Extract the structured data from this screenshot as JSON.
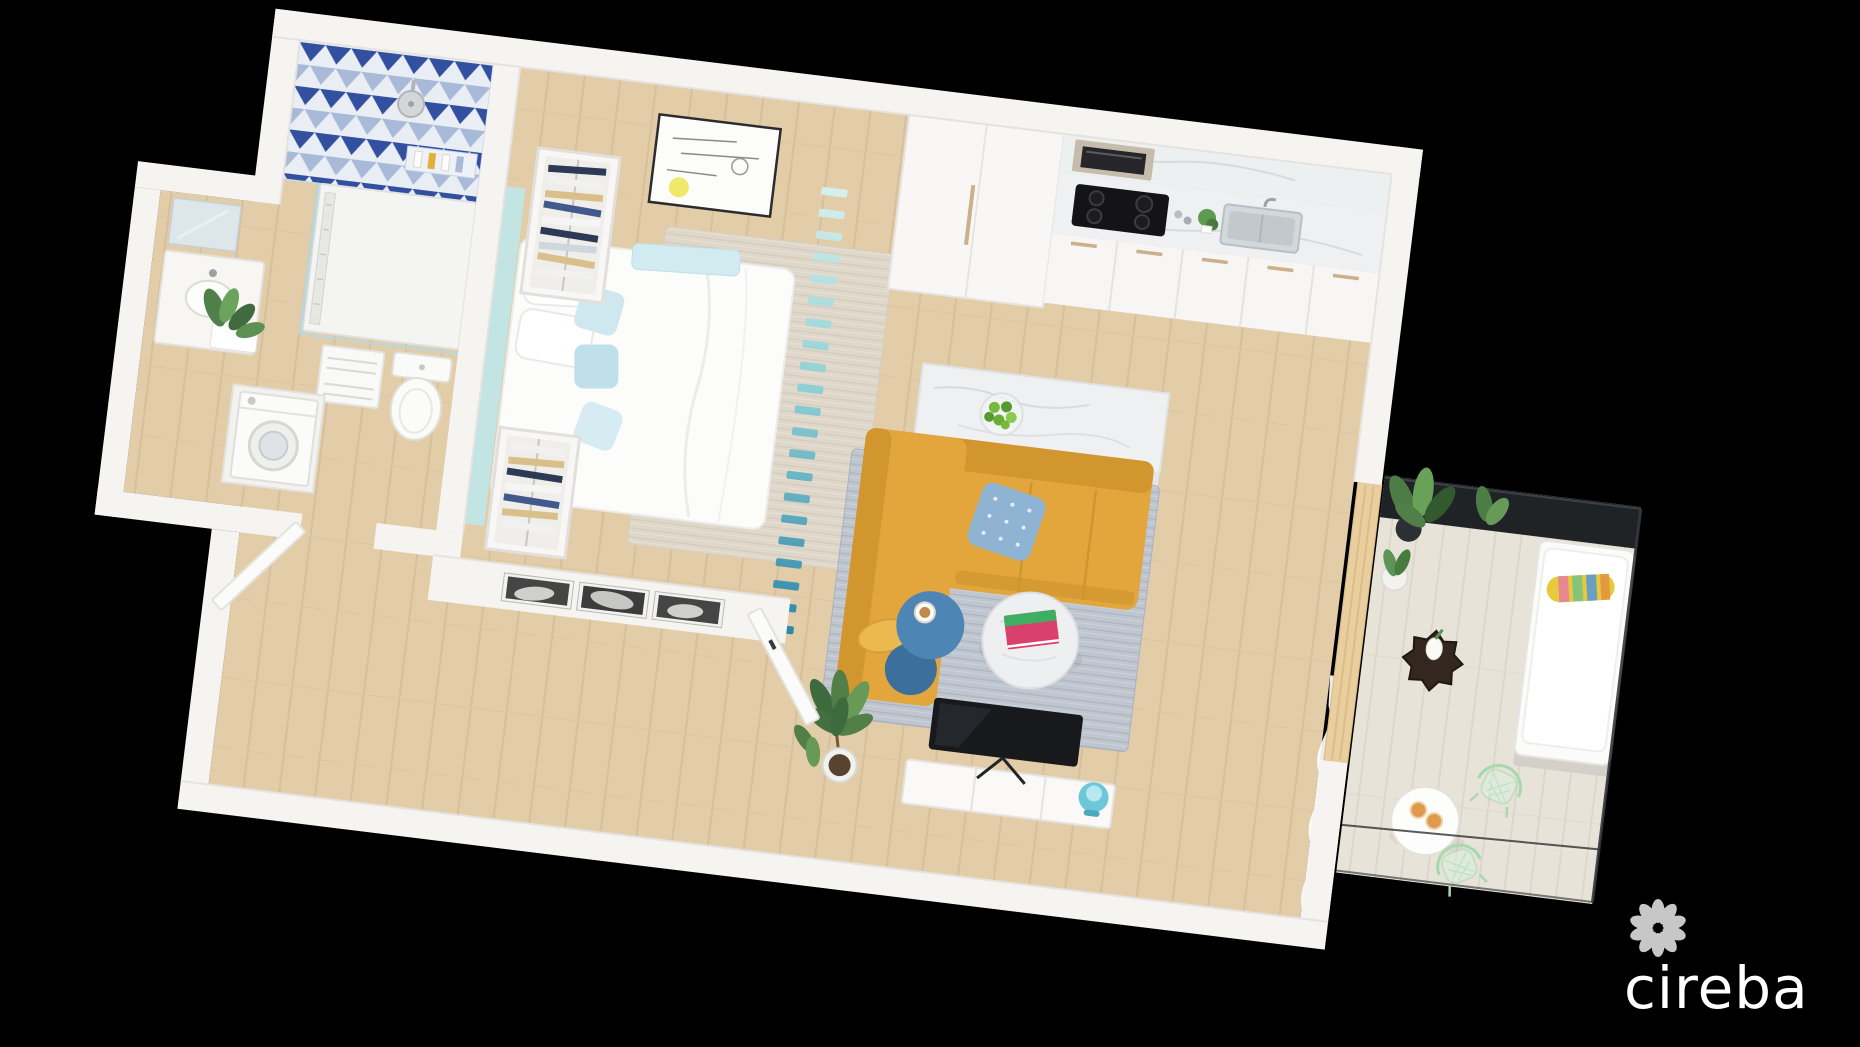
{
  "canvas": {
    "width": 1860,
    "height": 1047,
    "background": "#000000"
  },
  "watermark": {
    "logo_text": "cireba",
    "logo_mark": "flower-petal-ring-icon",
    "color": "#ffffff"
  },
  "scene": {
    "type": "3d-rendered-floor-plan",
    "view": "isometric top-down, tilted clockwise ~7 degrees on black background",
    "rooms": [
      {
        "name": "bathroom",
        "features": [
          "blue-triangle-mosaic-feature-wall",
          "walk-in-shower-tray",
          "rain-shower-head",
          "glass-shower-screen",
          "shower-niche-with-bottles",
          "toilet",
          "vanity-with-mirror",
          "green-plants",
          "towel-shelves"
        ]
      },
      {
        "name": "laundry-closet",
        "features": [
          "front-load-washing-machine",
          "white-door"
        ]
      },
      {
        "name": "bedroom",
        "features": [
          "double-bed-white-bedding",
          "aqua-headboard-panel",
          "two-open-wardrobes-with-clothes",
          "minimal-line-wall-art-with-yellow-dot",
          "low-wall-with-three-bw-photo-frames",
          "beige-area-rug",
          "white-door"
        ]
      },
      {
        "name": "kitchen",
        "features": [
          "white-tall-cabinets",
          "built-in-oven",
          "black-four-burner-cooktop",
          "marble-backsplash-and-counter",
          "stainless-sink",
          "white-base-cabinets",
          "marble-island",
          "glass-bowl-of-green-fruit"
        ]
      },
      {
        "name": "living-room",
        "features": [
          "mustard-l-shaped-sofa",
          "patterned-blue-cushion",
          "yellow-lumbar-cushion",
          "blue-two-tier-side-table",
          "coffee-cup",
          "round-marble-coffee-table",
          "pink-green-book",
          "grey-woven-rug",
          "tv-on-white-media-unit",
          "teal-table-lamp",
          "rubber-tree-plant",
          "sheer-white-curtain"
        ]
      },
      {
        "name": "balcony",
        "features": [
          "timber-slat-screen",
          "dark-glass-railing",
          "white-daybed",
          "multicolor-striped-bolster",
          "potted-plants",
          "dark-faceted-side-table-with-white-vase",
          "round-white-bistro-table",
          "two-orange-drinks",
          "two-mint-wire-chairs",
          "pale-wood-decking"
        ]
      }
    ],
    "divider": "teal-gradient-louvre-slat-partition between bedroom and living area"
  },
  "palette": {
    "background": "#000000",
    "wall": "#f5f4f1",
    "wall_shade": "#e5e3df",
    "floor_wood": "#e3cda9",
    "floor_plank_line": "#d7bf9c",
    "balcony_floor": "#e8e3d9",
    "tile_navy": "#32509f",
    "tile_light_blue": "#a9bad9",
    "tile_white": "#e9edf4",
    "headboard_aqua": "#c2e4e3",
    "divider_teal_light": "#d8f0ed",
    "divider_teal_mid": "#8fd0d4",
    "divider_teal_dark": "#2f86a8",
    "sofa_mustard": "#e2a63c",
    "sofa_shadow": "#d2962f",
    "pillow_blue": "#8fb3d2",
    "side_table_blue": "#4d86b4",
    "rug_grey": "#c0c6cf",
    "bedroom_rug": "#ded7ca",
    "marble": "#eef0f1",
    "cooktop_black": "#141416",
    "oven_steel": "#c6bcab",
    "timber_screen": "#e9cf9f",
    "railing_glass": "#15181c",
    "plant_green": "#527f48",
    "mint_chair": "#a6d9ae",
    "lamp_teal": "#6cc7d8",
    "daybed_white": "#fbfbfa",
    "book_pink": "#d9406b",
    "drink_orange": "#e09a4f"
  }
}
